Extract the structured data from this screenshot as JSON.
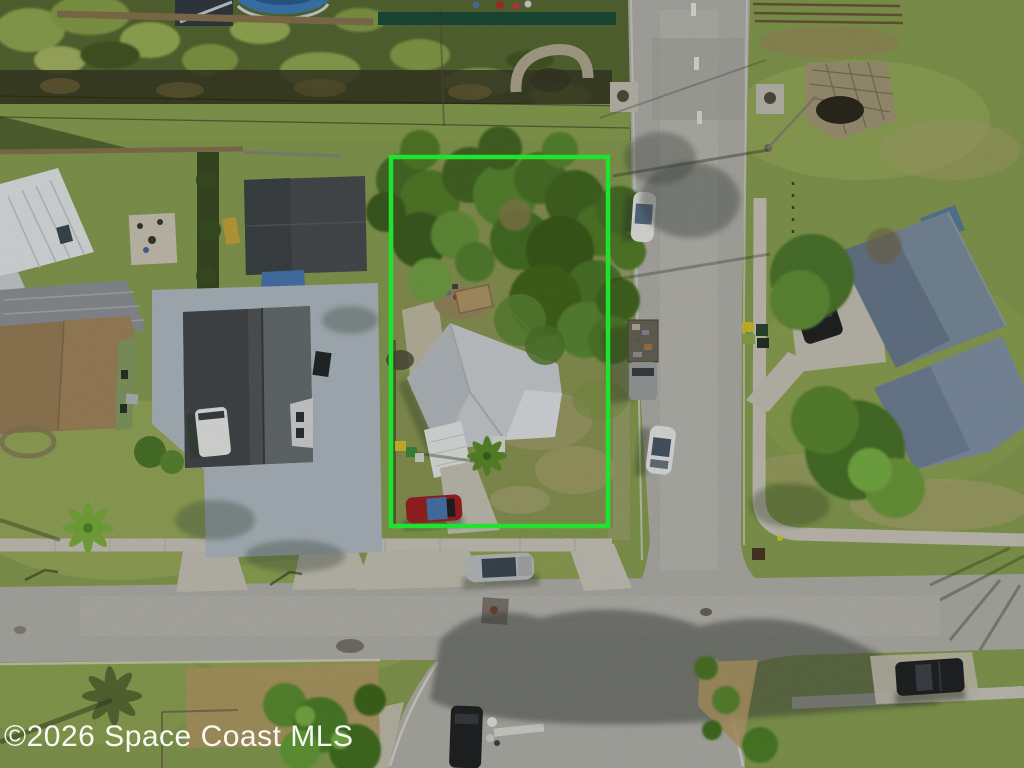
{
  "watermark": {
    "text": "©2026 Space Coast MLS"
  },
  "parcel_outline": {
    "color": "#1fe32e"
  },
  "colors": {
    "grass": "#8aa153",
    "grass_bright": "#9fb25f",
    "grass_dry": "#b0a771",
    "veg_dark": "#5a6c34",
    "ditch": "#3c3d26",
    "tree": "#55802c",
    "tree_dark": "#3f6020",
    "tree_light": "#74a544",
    "road": "#b5b4ae",
    "road_pale": "#c3c1ba",
    "sidewalk": "#cdc9be",
    "concrete": "#c9c5b8",
    "slab": "#b4bec6",
    "mulch": "#b59c66",
    "dirt": "#9a8a62",
    "subject_roof": "#ced3d7",
    "subject_roof_lit": "#e3e7ea",
    "garage_roof": "#4a4f52",
    "house_roof_dark": "#53585b",
    "house_roof_lit": "#6d7376",
    "brown_roof": "#9b8058",
    "metal_roof_white": "#e7eaeb",
    "carport_gray": "#90959a",
    "right_roof": "#7e90a2",
    "right_roof_lit": "#8495a8",
    "pool": "#3f7fba",
    "pool_rim": "#cfd8de",
    "awning_white": "#e9ebeb",
    "tarp_blue": "#4a7ab5",
    "red_car": "#a22322",
    "white_vehicle": "#ebecea",
    "silver_car": "#c0c4c4",
    "dark_vehicle": "#212426",
    "truck_cab": "#9fa3a4",
    "bin_yellow": "#d6c22e",
    "bin_green": "#3f8f3f",
    "fence_wood": "#8a7650",
    "fence_green": "#1e4f3a",
    "shadow": "#2e3a26",
    "watermark": "#ffffff"
  }
}
